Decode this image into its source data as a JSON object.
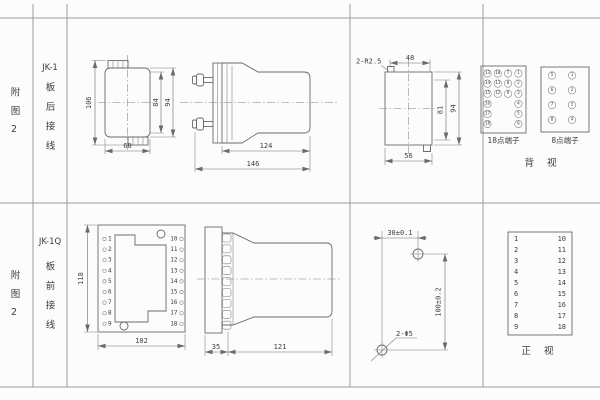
{
  "colors": {
    "background": "#fcfcfc",
    "line": "#6a6a6a",
    "grid": "#9c9c9c",
    "text": "#3d3d3d"
  },
  "left_columns": {
    "top": {
      "figure": "附图2",
      "model": "JK-1",
      "wiring": "板后接线"
    },
    "bottom": {
      "figure": "附图2",
      "model": "JK-1Q",
      "wiring": "板前接线"
    }
  },
  "top_row": {
    "front_view": {
      "height_overall": "106",
      "height_case": "84",
      "height_flange": "94",
      "width": "60"
    },
    "side_view": {
      "depth_case": "124",
      "depth_overall": "146"
    },
    "rear_view": {
      "corner_note": "2-R2.5",
      "width_top": "48",
      "height_inner": "81",
      "height_overall": "94",
      "width_bottom": "56"
    },
    "terminal_18": {
      "label": "18点端子",
      "col_13_18": [
        "13",
        "14",
        "15",
        "16",
        "17",
        "18"
      ],
      "col_10_12": [
        "10",
        "11",
        "12"
      ],
      "col_7_9": [
        "7",
        "8",
        "9"
      ],
      "col_1_6": [
        "1",
        "2",
        "3",
        "4",
        "5",
        "6"
      ]
    },
    "terminal_8": {
      "label": "8点端子",
      "left_col": [
        "5",
        "6",
        "7",
        "8"
      ],
      "right_col": [
        "1",
        "2",
        "3",
        "4"
      ]
    },
    "view_label": "背 视"
  },
  "bottom_row": {
    "front_view": {
      "height": "118",
      "width": "102",
      "left_terminals": [
        "1",
        "2",
        "3",
        "4",
        "5",
        "6",
        "7",
        "8",
        "9"
      ],
      "right_terminals": [
        "10",
        "11",
        "12",
        "13",
        "14",
        "15",
        "16",
        "17",
        "18"
      ]
    },
    "side_view": {
      "flange_depth": "35",
      "case_depth": "121"
    },
    "drilling_plan": {
      "hole_spacing_x": "30±0.1",
      "hole_spacing_y": "100±0.2",
      "hole_note": "2-Φ5"
    },
    "terminal_table": {
      "left": [
        "1",
        "2",
        "3",
        "4",
        "5",
        "6",
        "7",
        "8",
        "9"
      ],
      "right": [
        "10",
        "11",
        "12",
        "13",
        "14",
        "15",
        "16",
        "17",
        "18"
      ]
    },
    "view_label": "正 视"
  }
}
